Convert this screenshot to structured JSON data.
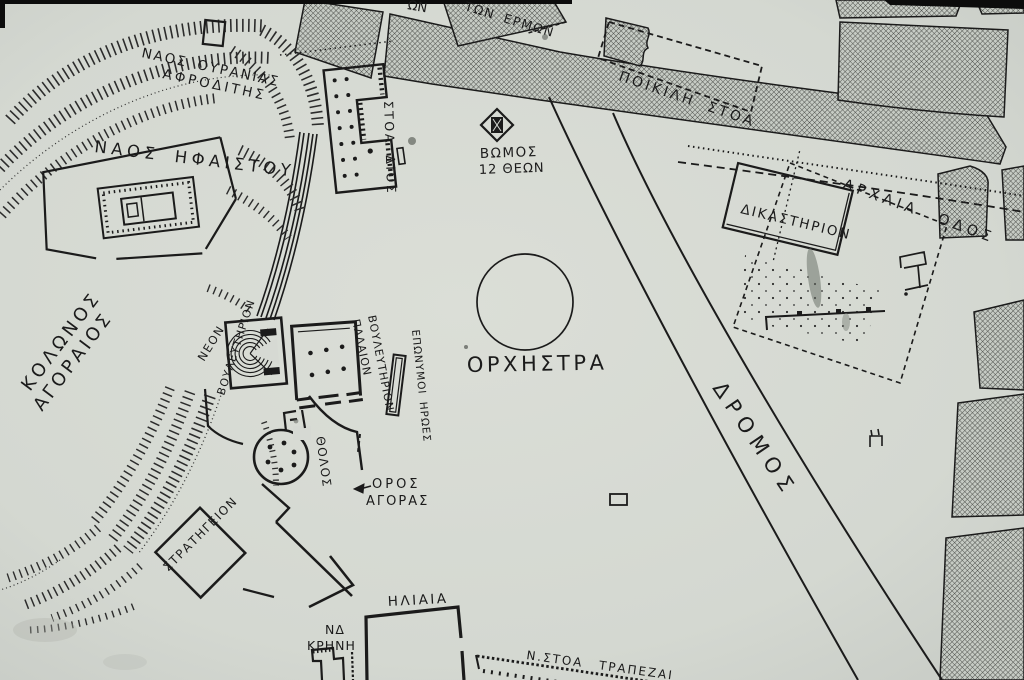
{
  "map": {
    "colors": {
      "paper": "#d6d9d3",
      "ink": "#1b1b1b",
      "block_hatch": "#4a4a4a"
    },
    "labels": {
      "hill_nw_line1": "ΚΟΛΩΝΟΣ",
      "hill_nw_line2": "ΑΓΟΡΑΙΟΣ",
      "temple_hephaistos": "ΝΑΟΣ ΗΦΑΙΣΤΟΥ",
      "temple_aphrodite_line1": "ΝΑΟΣ ΟΥΡΑΝΙΑΣ",
      "temple_aphrodite_line2": "ΑΦΡΟΔΙΤΗΣ",
      "stoa_of_zeus": "ΣΤΟΑ ΔΙΟΣ",
      "hermai": "ΤΩΝ ΕΡΜΩΝ",
      "edge_partial": "ΩΝ",
      "altar_line1": "ΒΩΜΟΣ",
      "altar_line2": "12 ΘΕΩΝ",
      "poikile_stoa": "ΠΟΙΚΙΛΗ ΣΤΟΑ",
      "archaia_odos": "ΑΡΧΑΙΑ ΟΔΟΣ",
      "dikastirion": "ΔΙΚΑΣΤΗΡΙΟΝ",
      "orchestra": "ΟΡΧΗΣΤΡΑ",
      "dromos": "ΔΡΟΜΟΣ",
      "new_bouleuterion_line1": "ΝΕΟΝ",
      "new_bouleuterion_line2": "ΒΟΥΛΕΥΤΗΡΙΟΝ",
      "old_bouleuterion_line1": "ΠΑΛΑΙΟΝ",
      "old_bouleuterion_line2": "ΒΟΥΛΕΥΤΗΡΙΟΝ",
      "eponymoi_heroes": "ΕΠΩΝΥΜΟΙ ΗΡΩΕΣ",
      "tholos": "ΘΟΛΟΣ",
      "horos_line1": "ΟΡΟΣ",
      "horos_line2": "ΑΓΟΡΑΣ",
      "strategeion": "ΣΤΡΑΤΗΓΕΙΟΝ",
      "sw_fountain_line1": "ΝΔ",
      "sw_fountain_line2": "ΚΡΗΝΗ",
      "heliaia": "ΗΛΙΑΙΑ",
      "south_stoa": "Ν.ΣΤΟΑ ΤΡΑΠΕΖΑΙ"
    }
  }
}
